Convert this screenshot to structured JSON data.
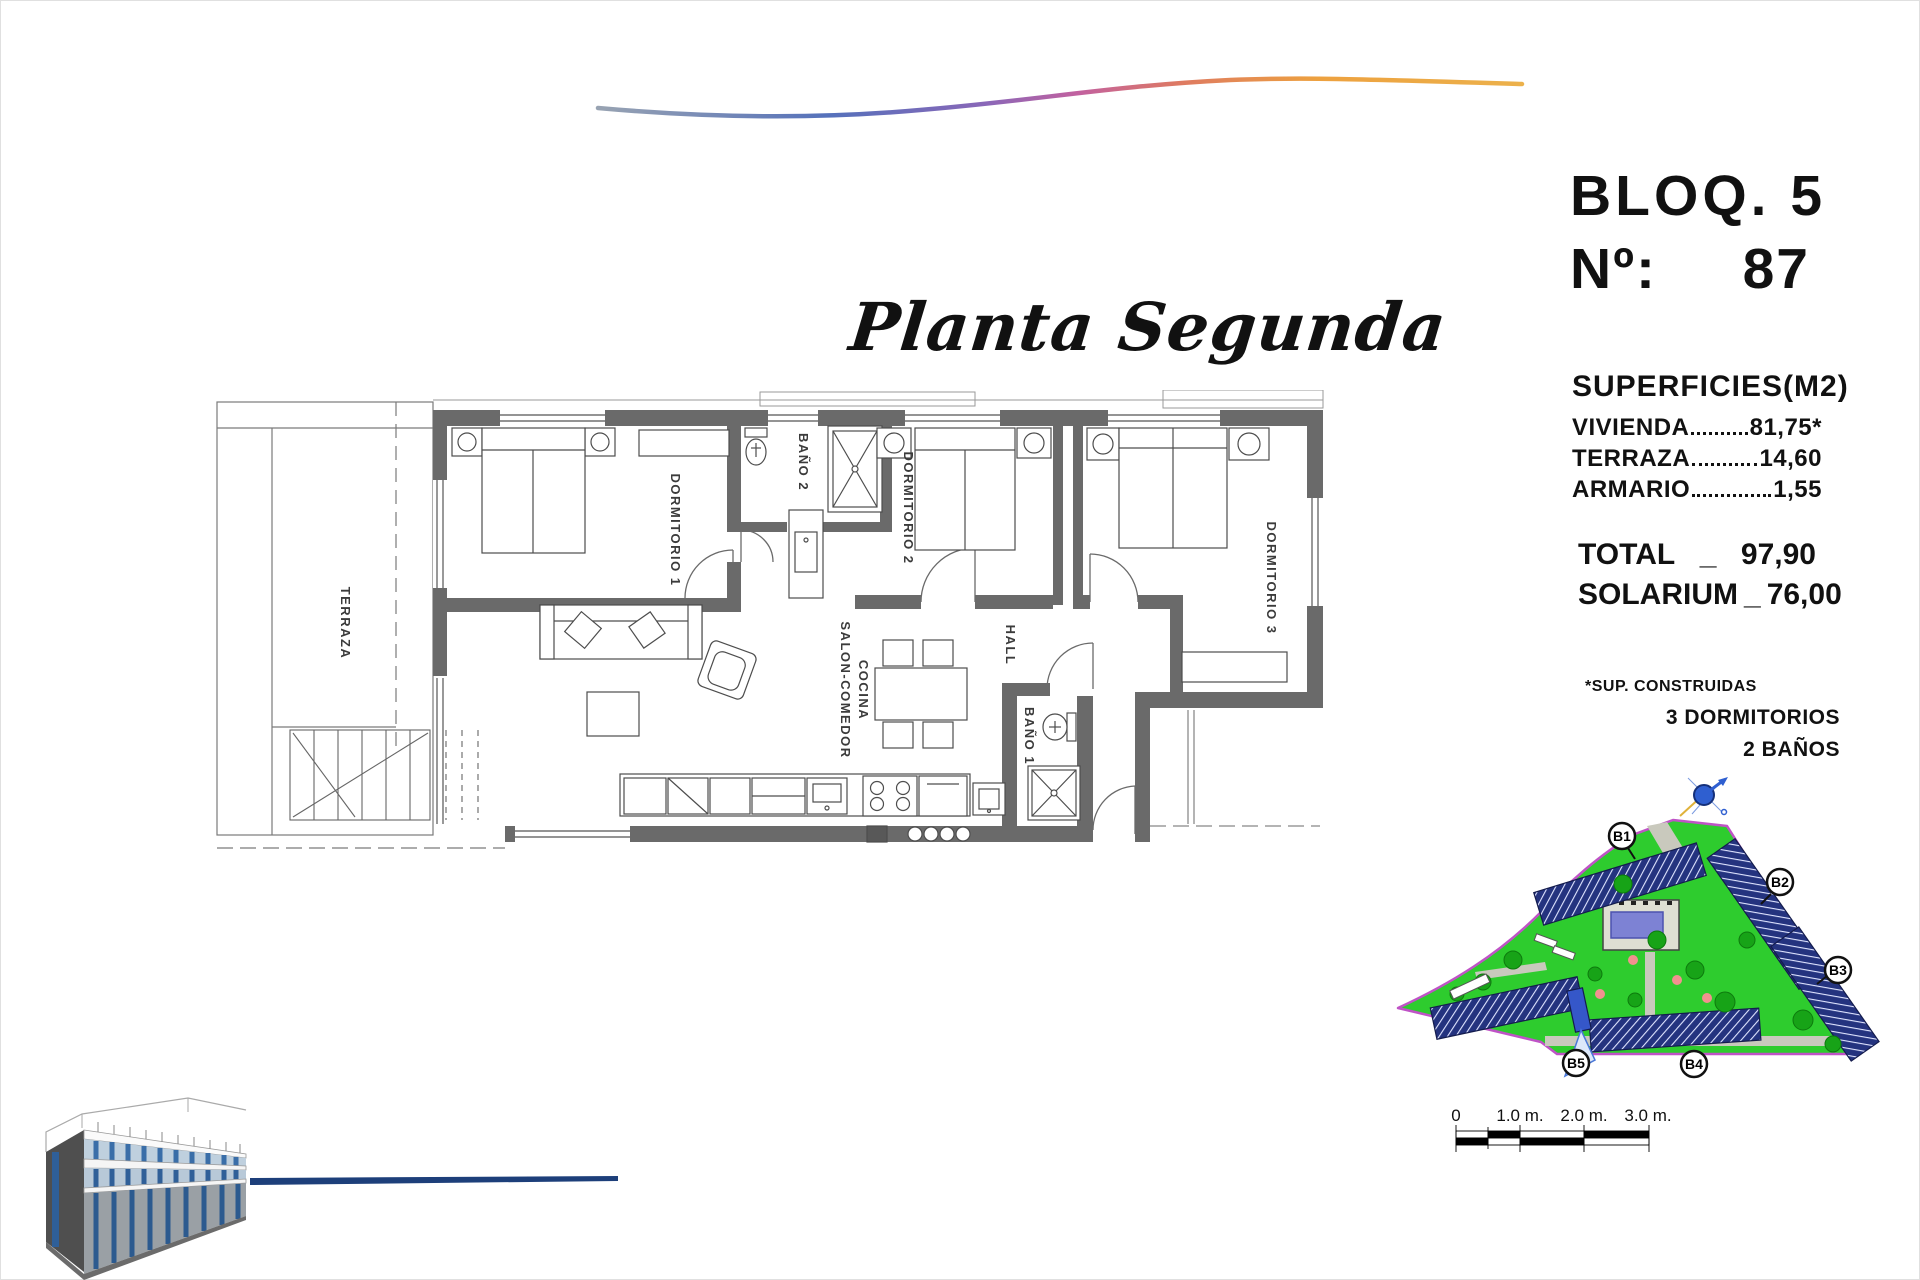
{
  "header": {
    "block": "BLOQ. 5",
    "number_label": "Nº:",
    "number_value": "87"
  },
  "plan_title": "Planta Segunda",
  "surfaces": {
    "title": "SUPERFICIES(M2)",
    "rows": [
      {
        "label": "VIVIENDA",
        "value": "81,75*"
      },
      {
        "label": "TERRAZA",
        "value": "14,60"
      },
      {
        "label": "ARMARIO",
        "value": "1,55"
      }
    ],
    "total_label": "TOTAL",
    "total_sep": "_",
    "total_value": "97,90",
    "solarium_label": "SOLARIUM",
    "solarium_sep": "_",
    "solarium_value": "76,00",
    "footnote": "*SUP. CONSTRUIDAS",
    "bedrooms": "3 DORMITORIOS",
    "bathrooms": "2 BAÑOS"
  },
  "floorplan": {
    "rooms": {
      "terraza": "TERRAZA",
      "dormitorio1": "DORMITORIO 1",
      "bano2": "BAÑO 2",
      "dormitorio2": "DORMITORIO 2",
      "dormitorio3": "DORMITORIO 3",
      "hall": "HALL",
      "bano1": "BAÑO 1",
      "salon_line1": "SALON-COMEDOR",
      "salon_line2": "COCINA"
    }
  },
  "siteplan": {
    "block_labels": [
      "B1",
      "B2",
      "B3",
      "B4",
      "B5"
    ]
  },
  "scalebar": {
    "ticks": [
      "0",
      "1.0 m.",
      "2.0 m.",
      "3.0 m."
    ]
  },
  "colors": {
    "site_green": "#2ecc2e",
    "boundary_purple": "#bf53c6",
    "building_navy": "#24337f",
    "pool_blue": "#7d82d4",
    "accent_line_blue": "#1d3f7a",
    "wall_gray": "#6a6a6a"
  }
}
